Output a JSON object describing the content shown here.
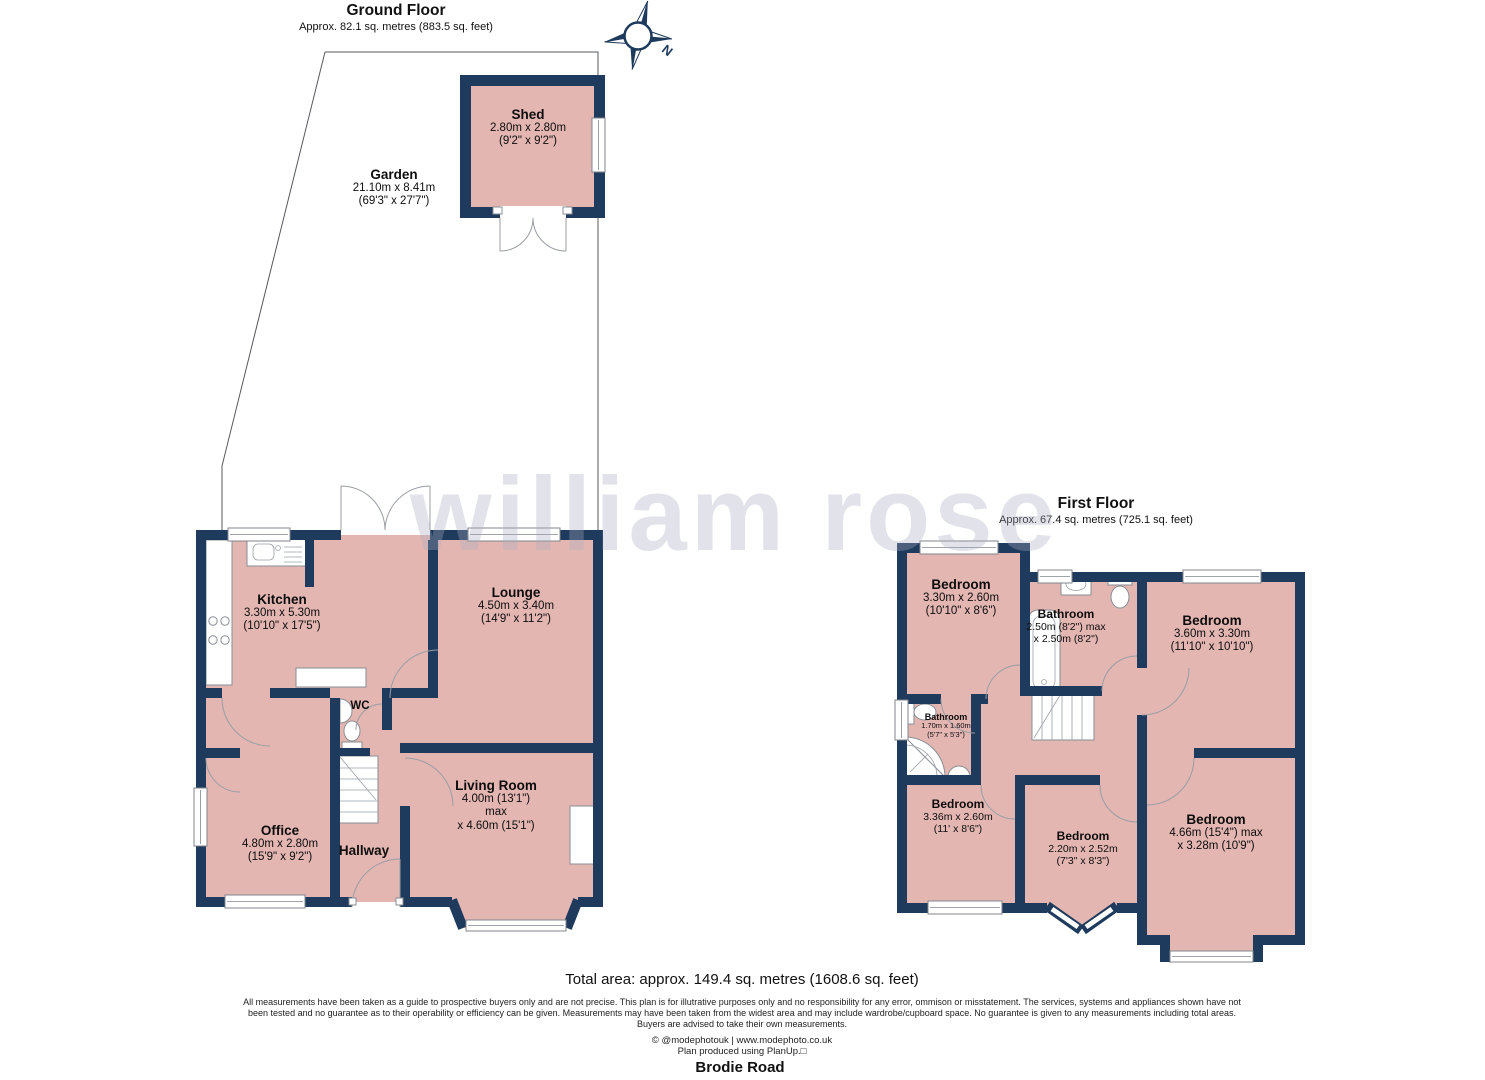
{
  "page": {
    "watermark": "william rose",
    "compass_label": "N",
    "total_area": "Total area: approx. 149.4 sq. metres (1608.6 sq. feet)",
    "disclaimer_line1": "All measurements have been taken as a guide to prospective buyers only and are not precise. This plan is for illutrative purposes only and no responsibility for any error, ommison or misstatement. The services, systems and appliances shown have not",
    "disclaimer_line2": "been tested and no guarantee as to their operability or efficiency can be given. Measurements may have been taken from the widest area and may include wardrobe/cupboard space. No guarantee is given to any measurements including total areas.",
    "disclaimer_line3": "Buyers are advised to take their own measurements.",
    "credit_line1": "© @modephotouk | www.modephoto.co.uk",
    "credit_line2": "Plan produced using PlanUp.□",
    "address": "Brodie Road"
  },
  "ground_floor": {
    "title": "Ground Floor",
    "subtitle": "Approx. 82.1 sq. metres (883.5 sq. feet)",
    "rooms": [
      {
        "name": "Garden",
        "line1": "21.10m x 8.41m",
        "line2": "(69'3\" x 27'7\")"
      },
      {
        "name": "Shed",
        "line1": "2.80m x 2.80m",
        "line2": "(9'2\" x 9'2\")"
      },
      {
        "name": "Kitchen",
        "line1": "3.30m x 5.30m",
        "line2": "(10'10\" x 17'5\")"
      },
      {
        "name": "Lounge",
        "line1": "4.50m x 3.40m",
        "line2": "(14'9\" x 11'2\")"
      },
      {
        "name": "WC",
        "line1": "",
        "line2": ""
      },
      {
        "name": "Living Room",
        "line1": "4.00m (13'1\") max",
        "line2": "x 4.60m (15'1\")"
      },
      {
        "name": "Office",
        "line1": "4.80m x 2.80m",
        "line2": "(15'9\" x 9'2\")"
      },
      {
        "name": "Hallway",
        "line1": "",
        "line2": ""
      }
    ]
  },
  "first_floor": {
    "title": "First Floor",
    "subtitle": "Approx. 67.4 sq. metres (725.1 sq. feet)",
    "rooms": [
      {
        "name": "Bedroom",
        "line1": "3.30m x 2.60m",
        "line2": "(10'10\" x 8'6\")"
      },
      {
        "name": "Bathroom",
        "line1": "2.50m (8'2\") max",
        "line2": "x 2.50m (8'2\")"
      },
      {
        "name": "Bedroom",
        "line1": "3.60m x 3.30m",
        "line2": "(11'10\" x 10'10\")"
      },
      {
        "name": "Bathroom",
        "line1": "1.70m x 1.60m",
        "line2": "(5'7\" x 5'3\")"
      },
      {
        "name": "Bedroom",
        "line1": "3.36m x 2.60m",
        "line2": "(11' x 8'6\")"
      },
      {
        "name": "Bedroom",
        "line1": "2.20m x 2.52m",
        "line2": "(7'3\" x 8'3\")"
      },
      {
        "name": "Bedroom",
        "line1": "4.66m (15'4\") max",
        "line2": "x 3.28m (10'9\")"
      }
    ]
  },
  "colors": {
    "wall": "#1e3a5c",
    "room_fill": "#e3b6b2",
    "watermark": "#a9adc0"
  }
}
